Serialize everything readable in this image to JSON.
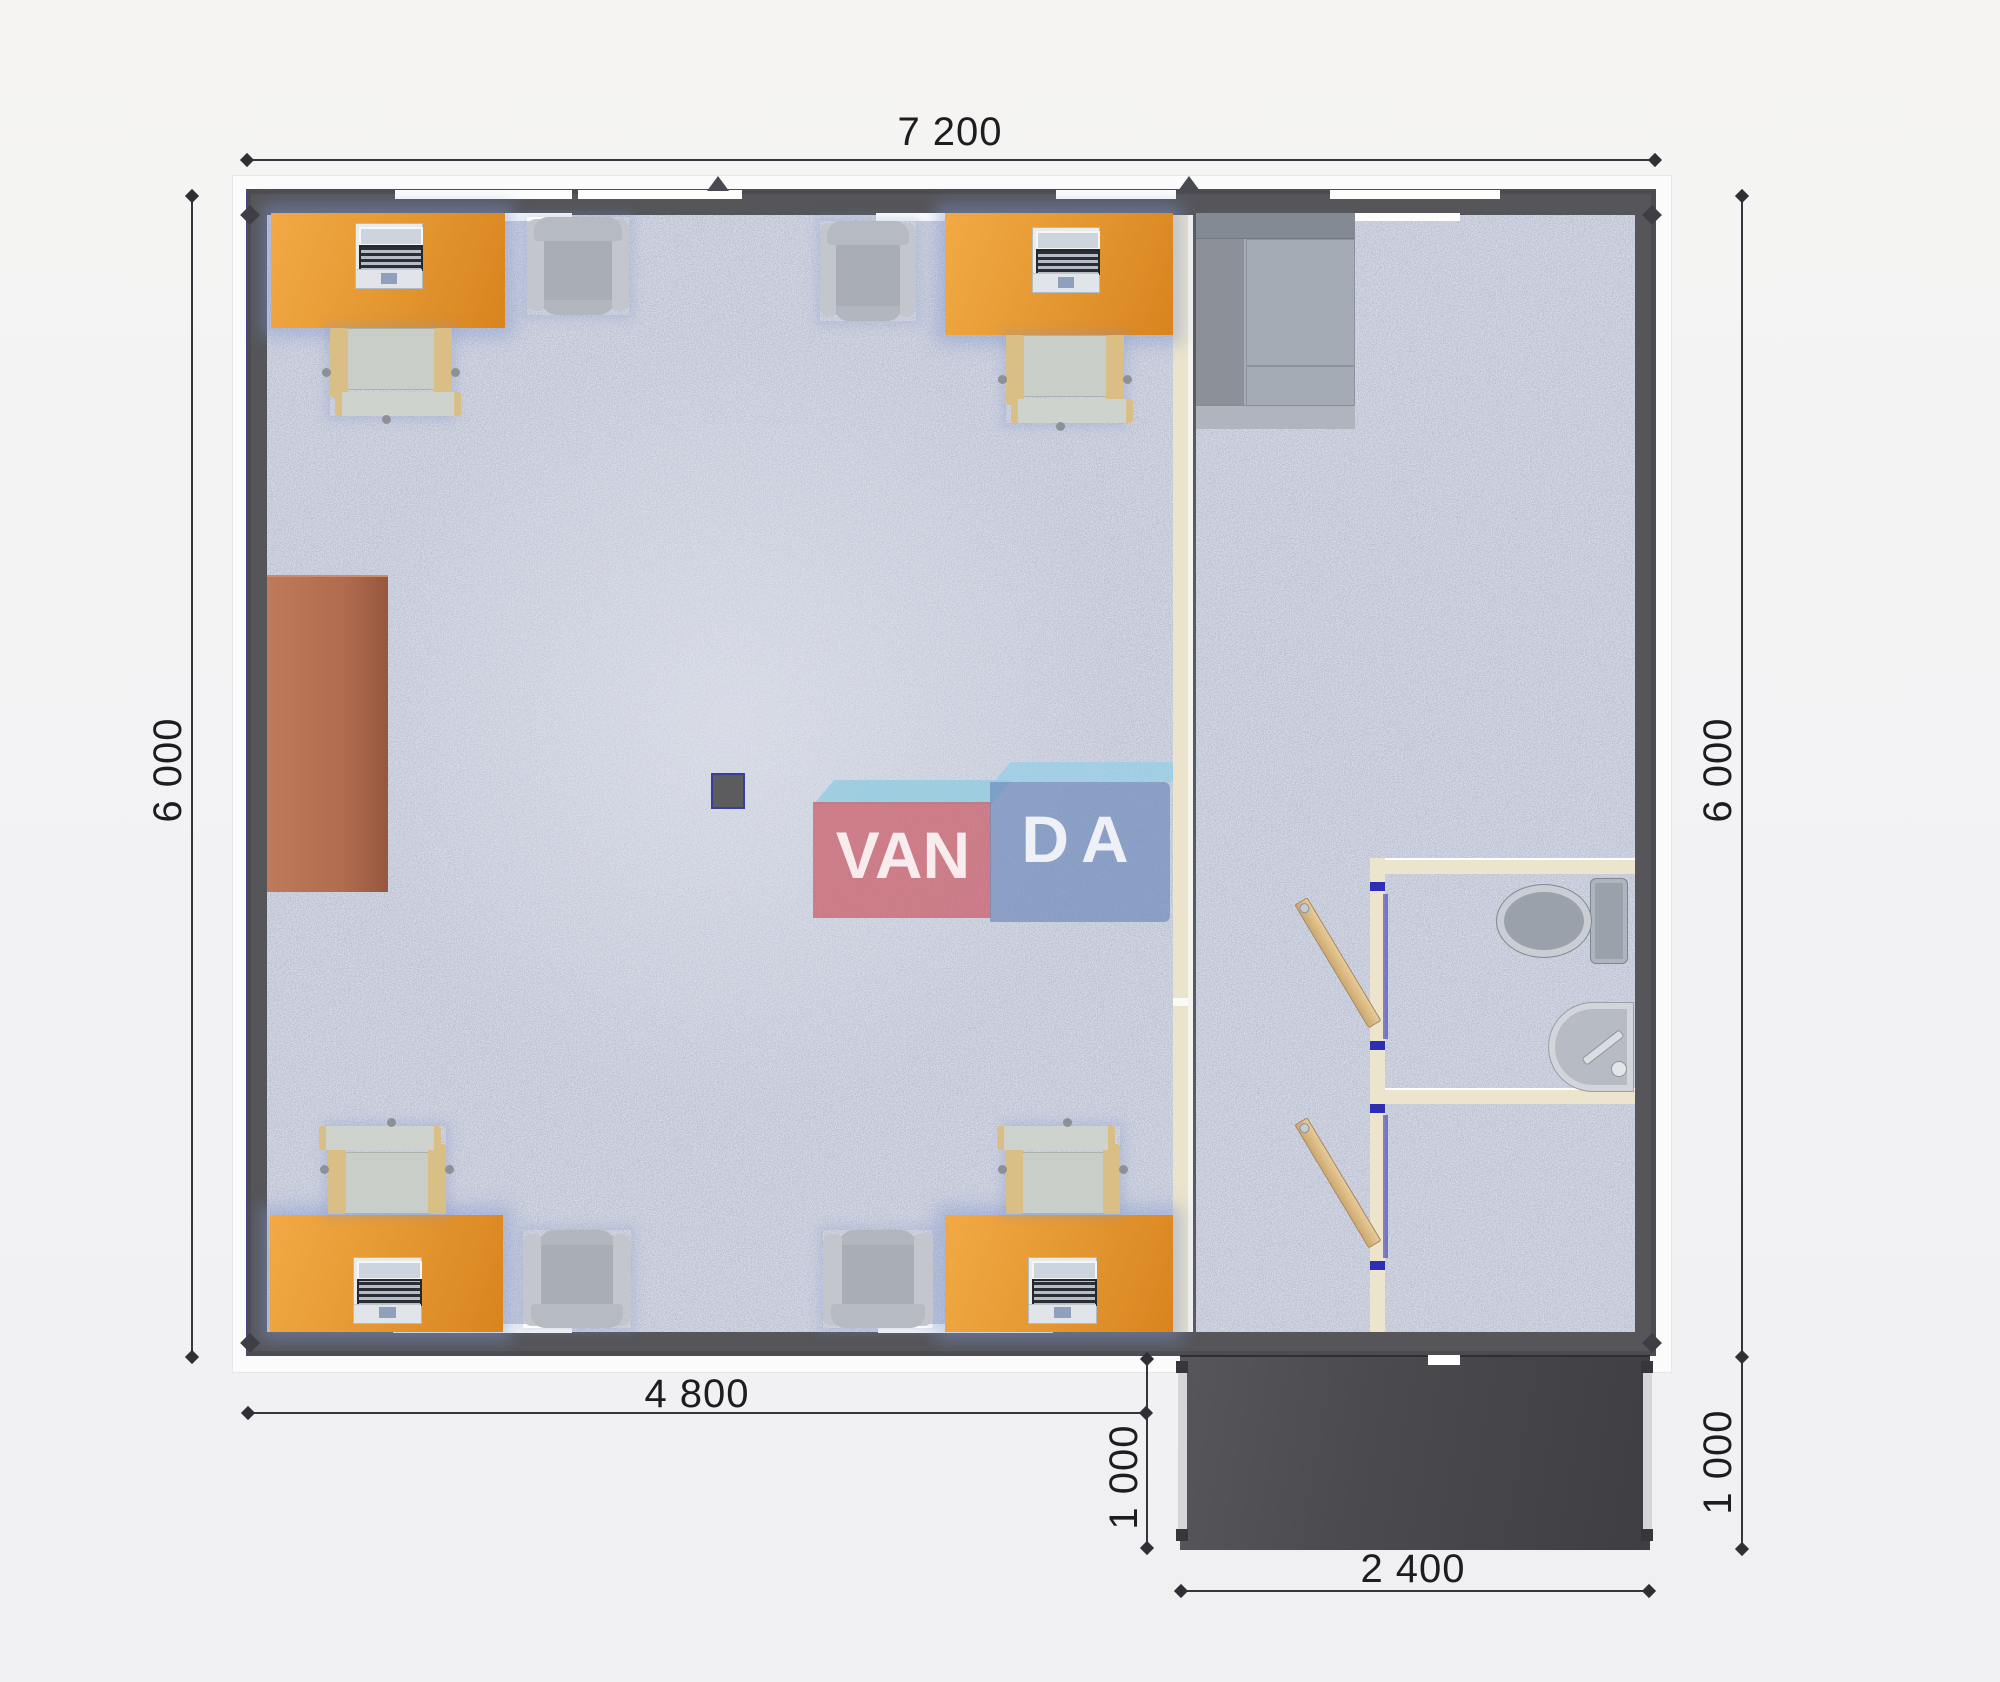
{
  "watermark": {
    "box_left_text": "VAN",
    "box_right_text": "DA"
  },
  "dimensions": {
    "top": "7 200",
    "left": "6 000",
    "right": "6 000",
    "bottom": "4 800",
    "porch_height_left": "1 000",
    "porch_height_right": "1 000",
    "porch_width": "2 400"
  },
  "colors": {
    "exterior_wall": "#55555a",
    "floor_base": "#bdc3d1",
    "desk_orange": "#e69a33",
    "partition_cream": "#ebe3cb",
    "door_wood": "#d4b179",
    "door_jamb_blue": "#2e2eb5",
    "porch_dark": "#4a4a4f",
    "meeting_table_brown": "#b06b4e",
    "logo_red": "#cb5c66",
    "logo_blue": "#708cbc",
    "logo_bevel": "#8ecbe0",
    "dimension_text": "#1d1d20"
  }
}
